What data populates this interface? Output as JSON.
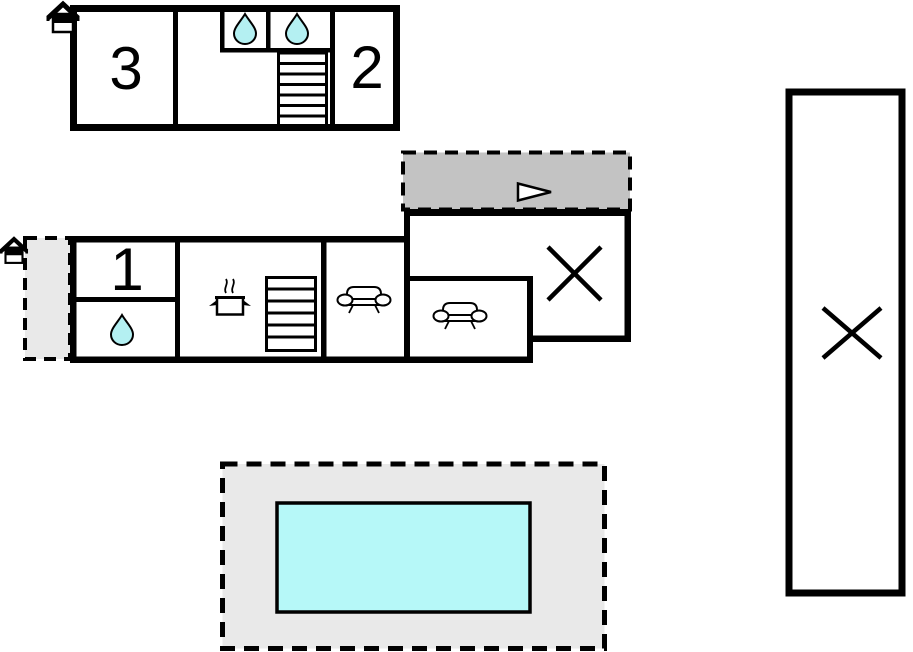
{
  "plan": {
    "background": "#ffffff",
    "rooms": {
      "room1": {
        "label": "1"
      },
      "room2": {
        "label": "2"
      },
      "room3": {
        "label": "3"
      }
    },
    "colors": {
      "wall": "#000000",
      "water_drop": "#b4f0f2",
      "pool_water": "#b6f8f8",
      "pool_deck": "#e9e9e9",
      "entry_area": "#e9e9e9",
      "driveway": "#c3c3c3",
      "arrow_fill": "#ffffff"
    },
    "icons": {
      "house": "house-icon",
      "water_drop": "water-drop-icon",
      "stairs": "stairs-icon",
      "cooking_pot": "cooking-pot-icon",
      "sofa": "sofa-icon",
      "direction_arrow": "arrow-right-icon",
      "cross_mark": "cross-icon"
    }
  }
}
